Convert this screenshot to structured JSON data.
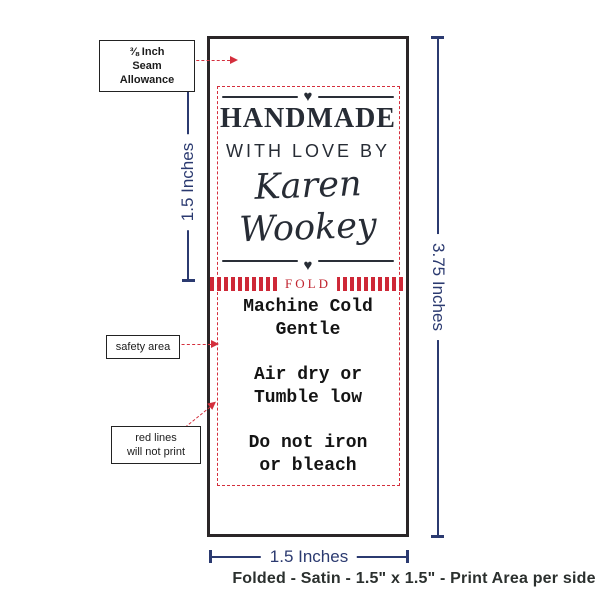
{
  "icons": {
    "heart": "♥"
  },
  "notes": {
    "seam": {
      "line1": "⅜ Inch",
      "line2": "Seam Allowance"
    },
    "safety": "safety area",
    "red_lines": {
      "line1": "red lines",
      "line2": "will not print"
    }
  },
  "dimensions": {
    "print_area_height": "1.5 Inches",
    "label_height": "3.75 Inches",
    "label_width": "1.5 Inches"
  },
  "label": {
    "heading": "HANDMADE",
    "subheading": "WITH LOVE BY",
    "name_line1": "Karen",
    "name_line2": "Wookey",
    "fold_text": "FOLD",
    "care_lines": [
      "Machine Cold",
      "Gentle",
      "Air dry or",
      "Tumble low",
      "Do not iron",
      "or bleach"
    ]
  },
  "caption": "Folded - Satin - 1.5\" x 1.5\" - Print Area per side",
  "colors": {
    "navy": "#2b3a70",
    "red": "#d42f3d",
    "ink": "#272c35",
    "caption": "#2b302e"
  }
}
